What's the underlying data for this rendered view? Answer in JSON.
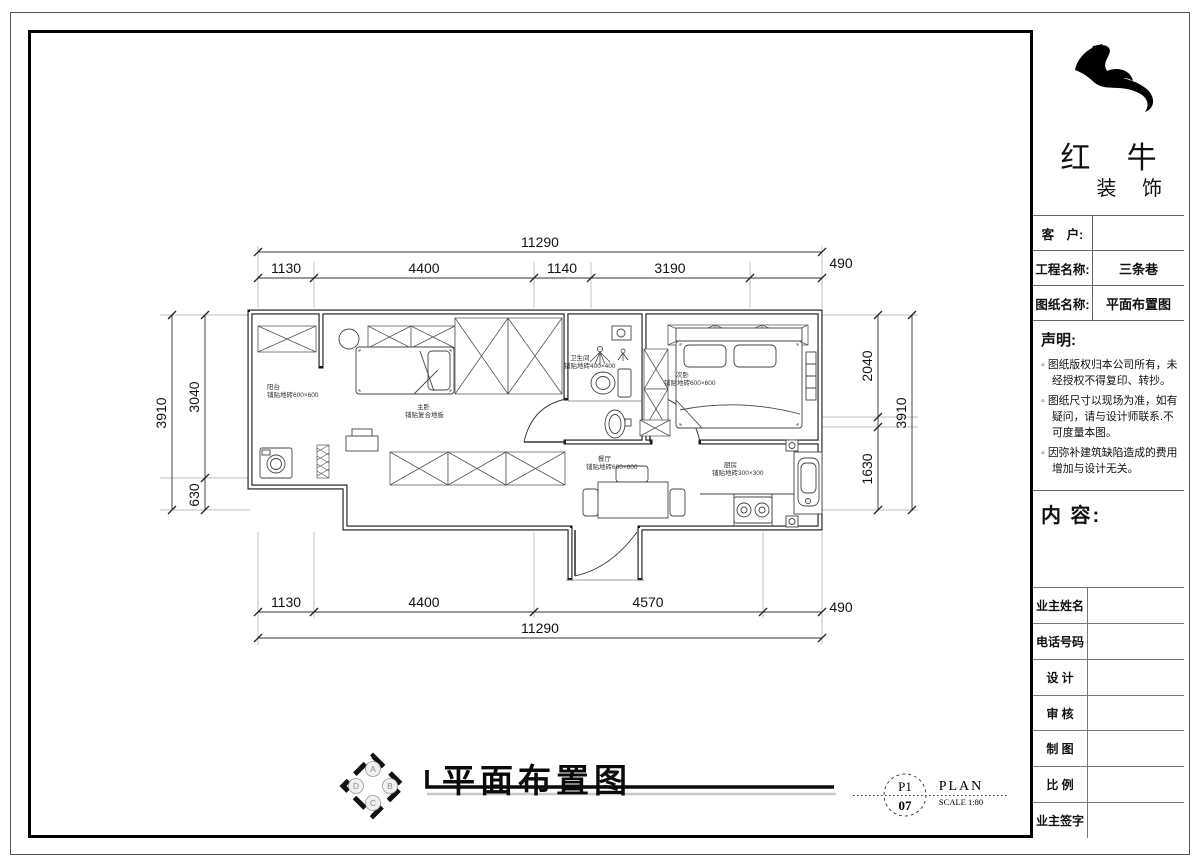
{
  "brand": {
    "line1": "红 牛",
    "line2": "装 饰"
  },
  "title_block": {
    "fields": [
      {
        "label": "客　户:",
        "value": ""
      },
      {
        "label": "工程名称:",
        "value": "三条巷"
      },
      {
        "label": "图纸名称:",
        "value": "平面布置图"
      }
    ],
    "statement": {
      "heading": "声明:",
      "items": [
        "图纸版权归本公司所有，未经授权不得复印、转抄。",
        "图纸尺寸以现场为准，如有疑问，请与设计师联系.不可度量本图。",
        "因弥补建筑缺陷造成的费用增加与设计无关。"
      ]
    },
    "content_label": "内 容:",
    "signoff": [
      {
        "label": "业主姓名",
        "value": ""
      },
      {
        "label": "电话号码",
        "value": ""
      },
      {
        "label": "设 计",
        "value": ""
      },
      {
        "label": "审 核",
        "value": ""
      },
      {
        "label": "制 图",
        "value": ""
      },
      {
        "label": "比 例",
        "value": ""
      },
      {
        "label": "业主签字",
        "value": ""
      }
    ]
  },
  "plan": {
    "rooms": [
      {
        "name": "阳台",
        "spec": "铺贴地砖600×600"
      },
      {
        "name": "主卧",
        "spec": "铺贴复合地板"
      },
      {
        "name": "卫生间",
        "spec": "铺贴地砖400×400"
      },
      {
        "name": "次卧",
        "spec": "铺贴地砖600×600"
      },
      {
        "name": "餐厅",
        "spec": "铺贴地砖600×600"
      },
      {
        "name": "厨房",
        "spec": "铺贴地砖300×300"
      }
    ],
    "dims": {
      "top_total": "11290",
      "top": [
        "1130",
        "4400",
        "1140",
        "3190",
        "490"
      ],
      "bottom": [
        "1130",
        "4400",
        "4570",
        "490"
      ],
      "bottom_total": "11290",
      "left_outer": "3910",
      "left": [
        "3040",
        "630"
      ],
      "right": [
        "2040",
        "1630"
      ],
      "right_outer": "3910"
    }
  },
  "footer": {
    "title": "平面布置图",
    "compass": [
      "A",
      "B",
      "C",
      "D"
    ],
    "sheet": {
      "no_top": "P1",
      "no_bottom": "07",
      "type": "PLAN",
      "scale": "SCALE 1:80"
    }
  },
  "colors": {
    "ink": "#111111",
    "paper": "#ffffff"
  }
}
